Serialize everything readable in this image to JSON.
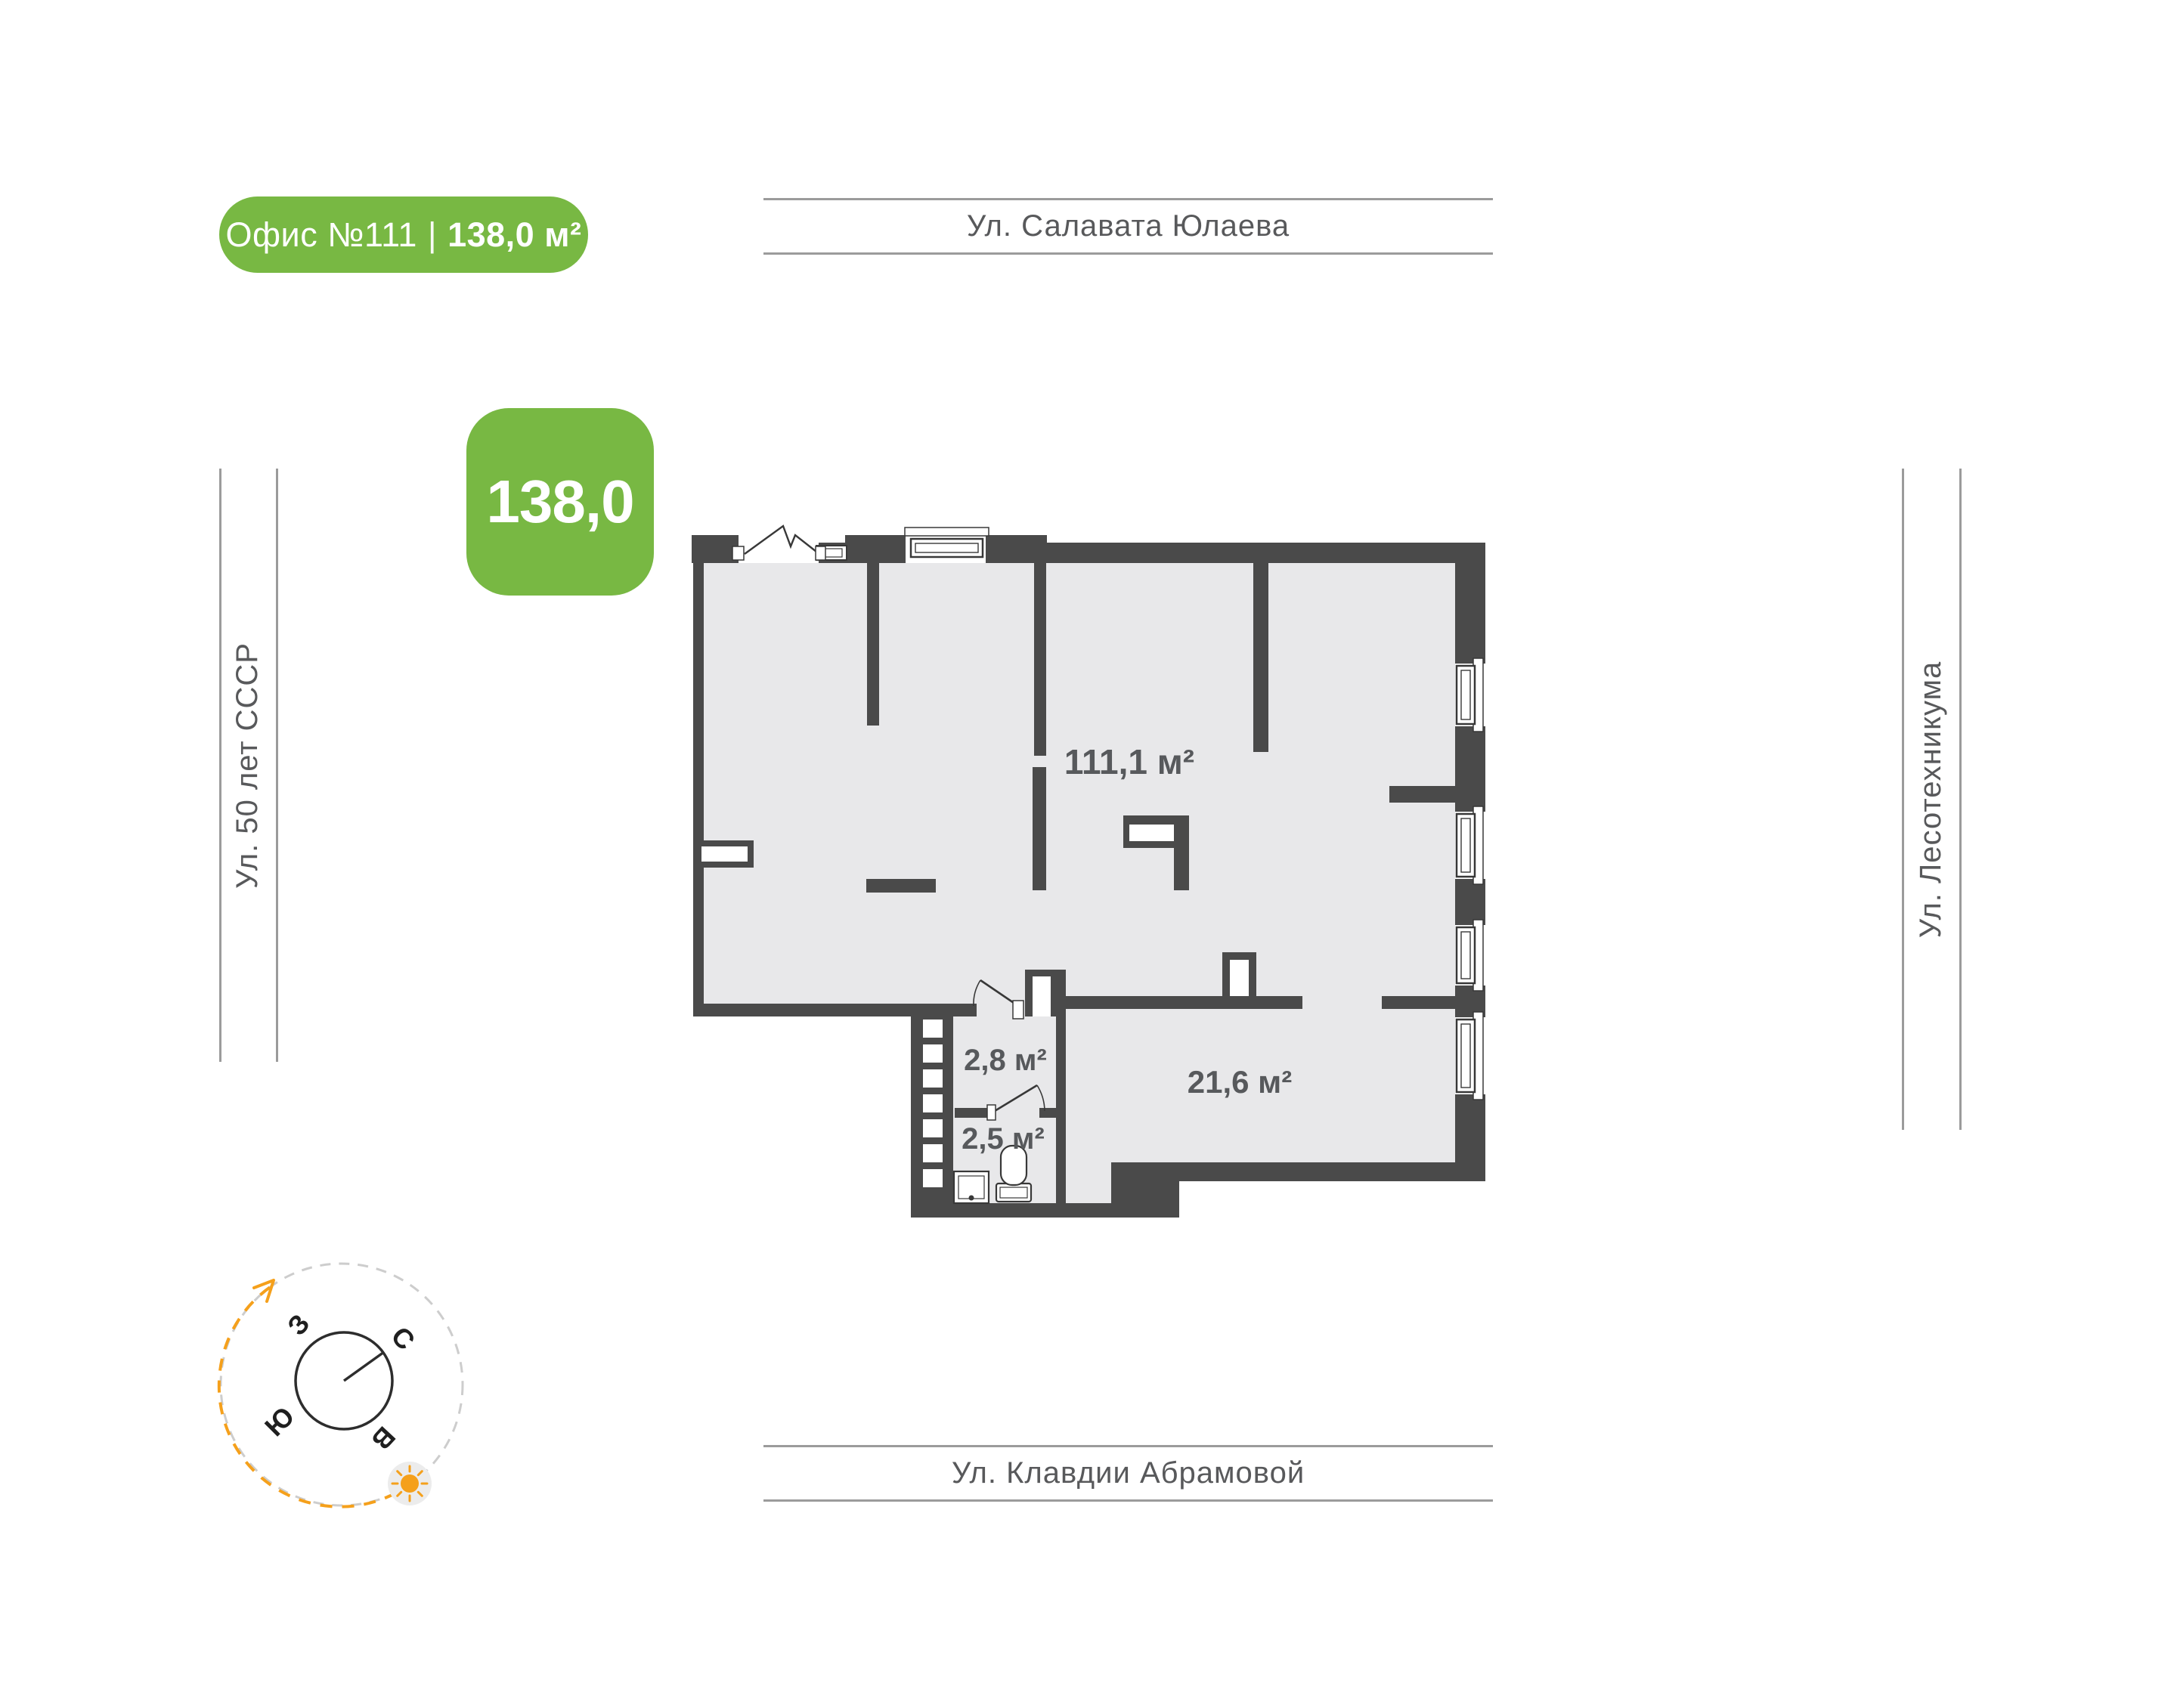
{
  "header_badge": {
    "office_no": "Офис №111",
    "divider": "|",
    "area": "138,0 м²"
  },
  "area_tile": {
    "value": "138,0"
  },
  "streets": {
    "top": "Ул. Салавата Юлаева",
    "left": "Ул. 50 лет СССР",
    "right": "Ул. Лесотехникума",
    "bottom": "Ул. Клавдии Абрамовой"
  },
  "plan": {
    "rooms": [
      {
        "id": "main-hall",
        "area_label": "111,1 м²"
      },
      {
        "id": "entry-hall",
        "area_label": "2,8 м²"
      },
      {
        "id": "wc",
        "area_label": "2,5 м²"
      },
      {
        "id": "cabinet",
        "area_label": "21,6 м²"
      }
    ]
  },
  "compass": {
    "west": "З",
    "north": "С",
    "south": "Ю",
    "east": "В"
  },
  "colors": {
    "accent_green": "#78B843",
    "accent_orange": "#F5A01B",
    "wall": "#4A4A4A",
    "floor": "#E8E8EA",
    "street_text": "#58595B",
    "street_line": "#9B9B9B",
    "room_label": "#57595C"
  }
}
